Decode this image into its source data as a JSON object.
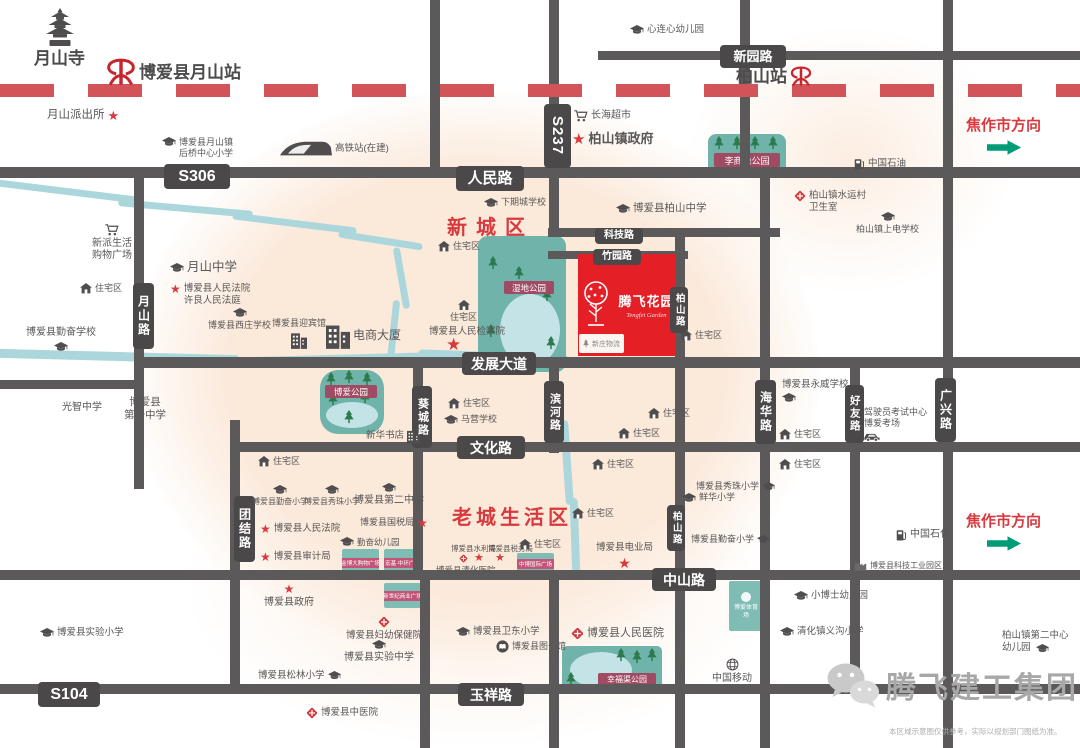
{
  "colors": {
    "road": "#5b5959",
    "roadLabelBg": "#4a4849",
    "railway": "#d25459",
    "red": "#d9383d",
    "projectRed": "#e51f26",
    "park": "#6fb3aa",
    "pond": "#c4e3e7",
    "tree": "#2c7a4e",
    "parkLabel": "#a04a63",
    "plazaBox": "#7fbcb4",
    "plazaLabel": "#c25577",
    "river": "#abd7dc",
    "text": "#595757",
    "arrow": "#009b77"
  },
  "project": {
    "name": "腾飞花园",
    "en": "Tengfei Garden",
    "annex": "新庄物流"
  },
  "areas": {
    "new_town": "新城区",
    "old_town": "老城生活区"
  },
  "directions": {
    "label": "焦作市方向"
  },
  "watermark": {
    "text": "腾飞建工集团"
  },
  "disclaimer": {
    "text": "本区域示意图仅供参考，实际以规划部门图纸为准。"
  },
  "roads": {
    "segments": [
      {
        "x": 0,
        "y": 167,
        "w": 1080,
        "h": 11
      },
      {
        "x": 598,
        "y": 51,
        "w": 482,
        "h": 9
      },
      {
        "x": 548,
        "y": 228,
        "w": 232,
        "h": 9
      },
      {
        "x": 548,
        "y": 251,
        "w": 140,
        "h": 8
      },
      {
        "x": 140,
        "y": 357,
        "w": 940,
        "h": 11
      },
      {
        "x": 0,
        "y": 380,
        "w": 140,
        "h": 9
      },
      {
        "x": 230,
        "y": 442,
        "w": 850,
        "h": 10
      },
      {
        "x": 0,
        "y": 570,
        "w": 1080,
        "h": 10
      },
      {
        "x": 0,
        "y": 684,
        "w": 1080,
        "h": 10
      },
      {
        "x": 430,
        "y": 0,
        "w": 10,
        "h": 172
      },
      {
        "x": 549,
        "y": 0,
        "w": 10,
        "h": 232
      },
      {
        "x": 740,
        "y": 0,
        "w": 10,
        "h": 172
      },
      {
        "x": 943,
        "y": 0,
        "w": 10,
        "h": 748
      },
      {
        "x": 134,
        "y": 167,
        "w": 10,
        "h": 322
      },
      {
        "x": 230,
        "y": 420,
        "w": 10,
        "h": 268
      },
      {
        "x": 413,
        "y": 357,
        "w": 10,
        "h": 223
      },
      {
        "x": 549,
        "y": 357,
        "w": 10,
        "h": 96
      },
      {
        "x": 675,
        "y": 228,
        "w": 10,
        "h": 520
      },
      {
        "x": 760,
        "y": 167,
        "w": 10,
        "h": 581
      },
      {
        "x": 850,
        "y": 357,
        "w": 10,
        "h": 331
      },
      {
        "x": 420,
        "y": 578,
        "w": 10,
        "h": 170
      },
      {
        "x": 549,
        "y": 578,
        "w": 10,
        "h": 170
      }
    ],
    "labels": [
      {
        "t": "S306",
        "x": 164,
        "y": 164,
        "w": 66,
        "h": 25,
        "fs": 16
      },
      {
        "t": "人民路",
        "x": 456,
        "y": 166,
        "w": 68,
        "h": 25,
        "fs": 15
      },
      {
        "t": "S237",
        "x": 544,
        "y": 104,
        "w": 27,
        "h": 64,
        "fs": 15,
        "rot": 1
      },
      {
        "t": "新园路",
        "x": 720,
        "y": 45,
        "w": 66,
        "h": 23,
        "fs": 13
      },
      {
        "t": "科技路",
        "x": 595,
        "y": 228,
        "w": 48,
        "h": 16,
        "fs": 10
      },
      {
        "t": "竹园路",
        "x": 593,
        "y": 249,
        "w": 48,
        "h": 16,
        "fs": 10
      },
      {
        "t": "发展大道",
        "x": 462,
        "y": 352,
        "w": 74,
        "h": 23,
        "fs": 14
      },
      {
        "t": "文化路",
        "x": 457,
        "y": 436,
        "w": 68,
        "h": 23,
        "fs": 14
      },
      {
        "t": "中山路",
        "x": 652,
        "y": 568,
        "w": 64,
        "h": 23,
        "fs": 14
      },
      {
        "t": "玉祥路",
        "x": 458,
        "y": 683,
        "w": 66,
        "h": 23,
        "fs": 14
      },
      {
        "t": "S104",
        "x": 38,
        "y": 682,
        "w": 62,
        "h": 25,
        "fs": 16
      },
      {
        "t": "月山路",
        "x": 133,
        "y": 283,
        "w": 21,
        "h": 66,
        "fs": 12,
        "v": 1
      },
      {
        "t": "团结路",
        "x": 234,
        "y": 496,
        "w": 21,
        "h": 66,
        "fs": 12,
        "v": 1
      },
      {
        "t": "葵城路",
        "x": 412,
        "y": 386,
        "w": 20,
        "h": 62,
        "fs": 11,
        "v": 1
      },
      {
        "t": "滨河路",
        "x": 544,
        "y": 381,
        "w": 20,
        "h": 62,
        "fs": 11,
        "v": 1
      },
      {
        "t": "柏山路",
        "x": 670,
        "y": 287,
        "w": 18,
        "h": 46,
        "fs": 9.5,
        "v": 1
      },
      {
        "t": "柏山路",
        "x": 667,
        "y": 505,
        "w": 18,
        "h": 46,
        "fs": 9.5,
        "v": 1
      },
      {
        "t": "海华路",
        "x": 755,
        "y": 380,
        "w": 21,
        "h": 64,
        "fs": 12,
        "v": 1
      },
      {
        "t": "好友路",
        "x": 845,
        "y": 385,
        "w": 19,
        "h": 58,
        "fs": 10.5,
        "v": 1
      },
      {
        "t": "广兴路",
        "x": 935,
        "y": 378,
        "w": 21,
        "h": 64,
        "fs": 12,
        "v": 1
      }
    ]
  },
  "rivers": [
    {
      "x": -8,
      "y": 188,
      "w": 150,
      "h": 7,
      "rot": 7
    },
    {
      "x": 118,
      "y": 205,
      "w": 135,
      "h": 7,
      "rot": 5
    },
    {
      "x": 232,
      "y": 220,
      "w": 125,
      "h": 7,
      "rot": 7
    },
    {
      "x": 338,
      "y": 237,
      "w": 85,
      "h": 7,
      "rot": 9
    },
    {
      "x": 398,
      "y": 247,
      "w": 7,
      "h": 62,
      "rot": -10
    },
    {
      "x": 390,
      "y": 300,
      "w": 7,
      "h": 62,
      "rot": 6
    },
    {
      "x": -5,
      "y": 352,
      "w": 245,
      "h": 9,
      "rot": 1.5
    },
    {
      "x": 228,
      "y": 355,
      "w": 205,
      "h": 9,
      "rot": -1.5
    },
    {
      "x": 418,
      "y": 352,
      "w": 150,
      "h": 9,
      "rot": 2
    },
    {
      "x": 552,
      "y": 366,
      "w": 8,
      "h": 60,
      "rot": -7
    },
    {
      "x": 563,
      "y": 420,
      "w": 8,
      "h": 85,
      "rot": -4
    },
    {
      "x": 571,
      "y": 498,
      "w": 8,
      "h": 80,
      "rot": -2
    }
  ],
  "parks": [
    {
      "name": "李商隐公园",
      "x": 708,
      "y": 134,
      "w": 78,
      "h": 42,
      "r": 8,
      "label": {
        "t": "李商隐公园",
        "x": 6,
        "y": 19,
        "w": 66,
        "h": 14,
        "fs": 9
      },
      "trees": [
        [
          6,
          2
        ],
        [
          24,
          2
        ],
        [
          42,
          2
        ],
        [
          60,
          2
        ]
      ]
    },
    {
      "name": "湿地公园",
      "x": 478,
      "y": 236,
      "w": 88,
      "h": 136,
      "r": 10,
      "label": {
        "t": "湿地公园",
        "x": 26,
        "y": 45,
        "w": 50,
        "h": 13,
        "fs": 8.5
      },
      "pond": {
        "x": 22,
        "y": 58,
        "w": 60,
        "h": 72
      },
      "trees": [
        [
          10,
          20
        ],
        [
          36,
          30
        ],
        [
          64,
          52
        ],
        [
          8,
          88
        ],
        [
          68,
          100
        ]
      ]
    },
    {
      "name": "博爱公园",
      "x": 320,
      "y": 370,
      "w": 64,
      "h": 64,
      "r": 18,
      "label": {
        "t": "博爱公园",
        "x": 5,
        "y": 15,
        "w": 52,
        "h": 13,
        "fs": 8.5
      },
      "pond": {
        "x": 6,
        "y": 32,
        "w": 52,
        "h": 26
      },
      "trees": [
        [
          6,
          2
        ],
        [
          24,
          0
        ],
        [
          42,
          2
        ],
        [
          8,
          22
        ],
        [
          40,
          20
        ],
        [
          24,
          40
        ]
      ]
    },
    {
      "name": "幸福渠公园",
      "x": 562,
      "y": 646,
      "w": 100,
      "h": 48,
      "r": 5,
      "label": {
        "t": "幸福渠公园",
        "x": 36,
        "y": 27,
        "w": 58,
        "h": 13,
        "fs": 8
      },
      "pond": {
        "x": 8,
        "y": 6,
        "w": 62,
        "h": 36
      },
      "trees": [
        [
          54,
          2
        ],
        [
          70,
          4
        ],
        [
          85,
          2
        ],
        [
          4,
          26
        ]
      ]
    }
  ],
  "plazas": [
    {
      "t": "金博大购物广场",
      "x": 342,
      "y": 549,
      "w": 37,
      "h": 27
    },
    {
      "t": "宏基·中环广场",
      "x": 384,
      "y": 549,
      "w": 37,
      "h": 27
    },
    {
      "t": "新世纪商业广场",
      "x": 384,
      "y": 583,
      "w": 37,
      "h": 25
    },
    {
      "t": "中博国际广场",
      "x": 517,
      "y": 553,
      "w": 37,
      "h": 22
    },
    {
      "t": "博爱体育场",
      "x": 729,
      "y": 581,
      "w": 34,
      "h": 50,
      "tall": 1
    }
  ],
  "landmarks": [
    {
      "i": "pagoda",
      "s": "t",
      "t": "月山寺",
      "x": 34,
      "y": 8,
      "fs": 17,
      "b": 1,
      "ta": "center",
      "c": "#4d4b4c"
    },
    {
      "i": "rail",
      "is": 30,
      "t": "博爱县月山站",
      "x": 106,
      "y": 58,
      "fs": 17,
      "b": 1,
      "c": "#4d4b4c"
    },
    {
      "i": "star",
      "is": 13,
      "s": "r",
      "t": "月山派出所",
      "x": 47,
      "y": 108,
      "fs": 11.5
    },
    {
      "i": "school",
      "t": "博爱县月山镇\n后桥中心小学",
      "x": 162,
      "y": 137,
      "fs": 9
    },
    {
      "i": "train",
      "t": "高铁站(在建)",
      "x": 280,
      "y": 140,
      "fs": 9.5
    },
    {
      "i": "school",
      "t": "心连心幼儿园",
      "x": 630,
      "y": 24,
      "fs": 9.5
    },
    {
      "i": "rail",
      "is": 22,
      "s": "r",
      "t": "柏山站",
      "x": 736,
      "y": 66,
      "fs": 17,
      "b": 1,
      "c": "#4d4b4c"
    },
    {
      "i": "cart",
      "t": "长海超市",
      "x": 574,
      "y": 110,
      "fs": 10
    },
    {
      "i": "star",
      "is": 15,
      "t": "柏山镇政府",
      "x": 572,
      "y": 131,
      "fs": 13,
      "b": 1
    },
    {
      "i": "gas",
      "t": "中国石油",
      "x": 854,
      "y": 158,
      "fs": 9.5
    },
    {
      "i": "hosp",
      "t": "柏山镇水运村\n卫生室",
      "x": 794,
      "y": 190,
      "fs": 9.5
    },
    {
      "i": "school",
      "s": "t",
      "t": "柏山镇上电学校",
      "x": 856,
      "y": 212,
      "fs": 9,
      "ta": "center"
    },
    {
      "i": "school",
      "t": "博爱县柏山中学",
      "x": 616,
      "y": 202,
      "fs": 10.5
    },
    {
      "i": "school",
      "t": "下期城学校",
      "x": 484,
      "y": 197,
      "fs": 9
    },
    {
      "i": "cart",
      "s": "t",
      "t": "新派生活\n购物广场",
      "x": 92,
      "y": 224,
      "fs": 10,
      "ta": "center"
    },
    {
      "i": "school",
      "t": "月山中学",
      "x": 170,
      "y": 260,
      "fs": 12.5
    },
    {
      "i": "star",
      "t": "博爱县人民法院\n许良人民法庭",
      "x": 170,
      "y": 283,
      "fs": 9.5
    },
    {
      "i": "house",
      "t": "住宅区",
      "x": 80,
      "y": 283,
      "fs": 9
    },
    {
      "i": "school",
      "s": "t",
      "t": "博爱县西庄学校",
      "x": 208,
      "y": 308,
      "fs": 9,
      "ta": "center"
    },
    {
      "i": "school",
      "s": "b",
      "t": "博爱县勤奋学校",
      "x": 26,
      "y": 327,
      "fs": 10,
      "ta": "center"
    },
    {
      "i": "bld",
      "s": "b",
      "t": "博爱县迎宾馆",
      "x": 272,
      "y": 318,
      "fs": 9,
      "ta": "center"
    },
    {
      "i": "bld",
      "is": 24,
      "t": "电商大厦",
      "x": 326,
      "y": 322,
      "fs": 12
    },
    {
      "i": "house",
      "t": "住宅区",
      "x": 258,
      "y": 456,
      "fs": 9
    },
    {
      "i": "house",
      "t": "住宅区",
      "x": 438,
      "y": 241,
      "fs": 9
    },
    {
      "i": "house",
      "s": "t",
      "t": "住宅区",
      "x": 450,
      "y": 300,
      "fs": 9,
      "ta": "center"
    },
    {
      "t": "博爱县人民检察院",
      "x": 429,
      "y": 326,
      "fs": 9.5
    },
    {
      "i": "star",
      "is": 17,
      "t": "",
      "x": 446,
      "y": 336
    },
    {
      "i": "house",
      "t": "住宅区",
      "x": 680,
      "y": 330,
      "fs": 9
    },
    {
      "i": "house",
      "t": "住宅区",
      "x": 448,
      "y": 398,
      "fs": 9
    },
    {
      "i": "school",
      "t": "马营学校",
      "x": 444,
      "y": 414,
      "fs": 9
    },
    {
      "i": "bld",
      "is": 13,
      "s": "r",
      "t": "新华书店",
      "x": 366,
      "y": 429,
      "fs": 9.5
    },
    {
      "t": "光智中学",
      "x": 62,
      "y": 402,
      "fs": 10
    },
    {
      "t": "博爱县\n第一中学",
      "x": 124,
      "y": 396,
      "fs": 10.5,
      "ta": "center"
    },
    {
      "i": "school",
      "s": "b",
      "t": "博爱县永威学校",
      "x": 782,
      "y": 379,
      "fs": 9.5
    },
    {
      "i": "house",
      "t": "住宅区",
      "x": 779,
      "y": 429,
      "fs": 9
    },
    {
      "i": "house",
      "t": "住宅区",
      "x": 779,
      "y": 459,
      "fs": 9
    },
    {
      "i": "car",
      "s": "b",
      "t": "驾驶员考试中心\n博爱考场",
      "x": 864,
      "y": 407,
      "fs": 9
    },
    {
      "i": "house",
      "t": "住宅区",
      "x": 648,
      "y": 408,
      "fs": 9
    },
    {
      "i": "house",
      "t": "住宅区",
      "x": 618,
      "y": 428,
      "fs": 9
    },
    {
      "i": "house",
      "t": "住宅区",
      "x": 592,
      "y": 459,
      "fs": 9
    },
    {
      "i": "house",
      "t": "住宅区",
      "x": 572,
      "y": 508,
      "fs": 9
    },
    {
      "i": "school",
      "is": 13,
      "s": "r",
      "t": "博爱县秀珠小学",
      "x": 696,
      "y": 481,
      "fs": 9
    },
    {
      "i": "school",
      "t": "鲜华小学",
      "x": 682,
      "y": 492,
      "fs": 9
    },
    {
      "i": "school",
      "is": 13,
      "s": "r",
      "t": "博爱县勤奋小学",
      "x": 691,
      "y": 534,
      "fs": 9
    },
    {
      "i": "star",
      "is": 14,
      "s": "b",
      "t": "博爱县电业局",
      "x": 596,
      "y": 542,
      "fs": 9.5,
      "ta": "center"
    },
    {
      "i": "school",
      "s": "t",
      "t": "博爱县勤奋小学",
      "x": 252,
      "y": 485,
      "fs": 8,
      "ta": "center"
    },
    {
      "i": "school",
      "s": "t",
      "t": "博爱县秀珠小学",
      "x": 304,
      "y": 485,
      "fs": 8,
      "ta": "center"
    },
    {
      "i": "school",
      "s": "t",
      "t": "博爱县第二中学",
      "x": 354,
      "y": 483,
      "fs": 10,
      "ta": "center"
    },
    {
      "i": "star",
      "t": "博爱县人民法院",
      "x": 260,
      "y": 523,
      "fs": 9.5
    },
    {
      "i": "star",
      "t": "博爱县审计局",
      "x": 260,
      "y": 551,
      "fs": 9.5
    },
    {
      "i": "star",
      "is": 12,
      "s": "r",
      "t": "博爱县国税局",
      "x": 360,
      "y": 517,
      "fs": 9
    },
    {
      "i": "school",
      "t": "勤奋幼儿园",
      "x": 340,
      "y": 537,
      "fs": 8.5
    },
    {
      "i": "star",
      "s": "t",
      "t": "博爱县政府",
      "x": 264,
      "y": 583,
      "fs": 10,
      "ta": "center"
    },
    {
      "t": "博爱县水利局",
      "x": 451,
      "y": 544,
      "fs": 7.5
    },
    {
      "t": "博爱县税务局",
      "x": 488,
      "y": 544,
      "fs": 7.5
    },
    {
      "i": "hosp",
      "is": 9,
      "t": "",
      "x": 459,
      "y": 554
    },
    {
      "i": "star",
      "is": 11,
      "t": "",
      "x": 474,
      "y": 553
    },
    {
      "i": "star",
      "is": 11,
      "t": "",
      "x": 495,
      "y": 553
    },
    {
      "t": "博爱县清化医院",
      "x": 436,
      "y": 565,
      "fs": 8.5
    },
    {
      "i": "house",
      "t": "住宅区",
      "x": 519,
      "y": 539,
      "fs": 9
    },
    {
      "i": "hosp",
      "s": "t",
      "t": "博爱县妇幼保健院",
      "x": 346,
      "y": 616,
      "fs": 9.5,
      "ta": "center"
    },
    {
      "i": "school",
      "t": "博爱县实验小学",
      "x": 40,
      "y": 627,
      "fs": 9.5
    },
    {
      "i": "school",
      "s": "t",
      "t": "博爱县实验中学",
      "x": 344,
      "y": 640,
      "fs": 10,
      "ta": "center"
    },
    {
      "i": "school",
      "is": 13,
      "s": "r",
      "t": "博爱县松林小学",
      "x": 258,
      "y": 670,
      "fs": 9.5
    },
    {
      "i": "hosp",
      "t": "博爱县中医院",
      "x": 306,
      "y": 707,
      "fs": 9.5
    },
    {
      "i": "school",
      "t": "博爱县卫东小学",
      "x": 456,
      "y": 626,
      "fs": 9.5
    },
    {
      "i": "book",
      "t": "博爱县图书馆",
      "x": 496,
      "y": 640,
      "fs": 9
    },
    {
      "i": "hosp",
      "is": 13,
      "t": "博爱县人民医院",
      "x": 571,
      "y": 627,
      "fs": 11
    },
    {
      "i": "gas",
      "t": "中国石化",
      "x": 896,
      "y": 529,
      "fs": 10
    },
    {
      "i": "factory",
      "t": "博爱县科技工业园区",
      "x": 854,
      "y": 560,
      "fs": 8
    },
    {
      "i": "school",
      "t": "小博士幼儿园",
      "x": 794,
      "y": 590,
      "fs": 9.5
    },
    {
      "i": "school",
      "t": "清化镇义沟小学",
      "x": 780,
      "y": 626,
      "fs": 9.5
    },
    {
      "t": "柏山镇第二中心\n幼儿园",
      "x": 1002,
      "y": 630,
      "fs": 9.5
    },
    {
      "i": "school",
      "is": 13,
      "t": "",
      "x": 1036,
      "y": 644
    },
    {
      "i": "globe",
      "s": "t",
      "t": "中国移动",
      "x": 712,
      "y": 658,
      "fs": 10,
      "ta": "center"
    }
  ]
}
